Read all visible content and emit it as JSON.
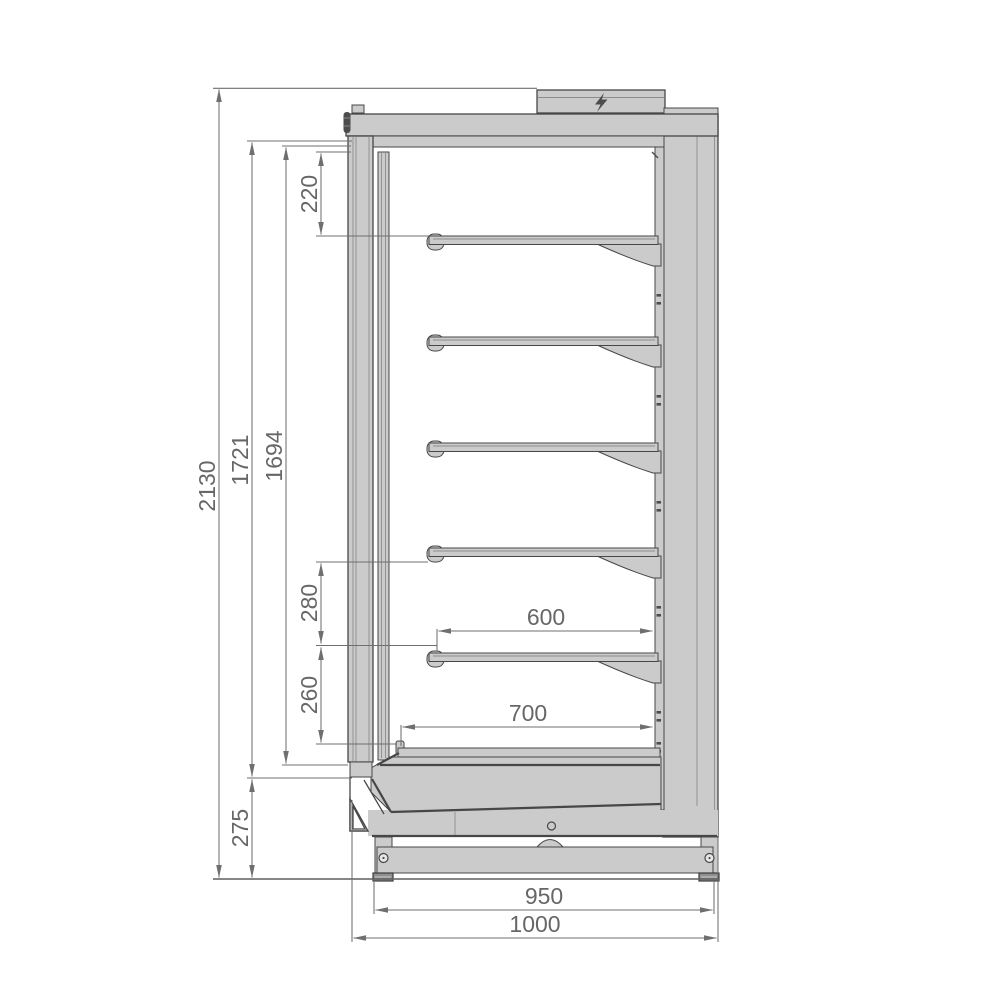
{
  "dimensions_mm": {
    "overall_height": "2130",
    "door_height": "1721",
    "interior_height": "1694",
    "top_to_first_shelf": "220",
    "shelf_pitch_upper": "280",
    "shelf_pitch_lower": "260",
    "base_height": "275",
    "shelf_depth": "600",
    "bottom_deck_depth": "700",
    "body_width": "950",
    "overall_width": "1000"
  },
  "icons": {
    "electrical_connection": "lightning-bolt"
  },
  "colors": {
    "panel_fill": "#cbcbcb",
    "outline": "#474747",
    "dimension_lines": "#6f6f6f",
    "dimension_text": "#676767",
    "background": "#ffffff"
  },
  "structure": {
    "shelves": 5
  }
}
